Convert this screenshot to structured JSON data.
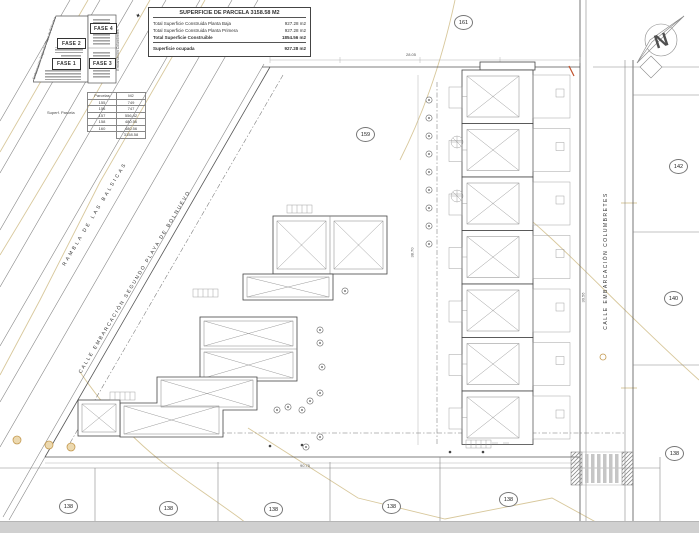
{
  "summary_table": {
    "title": "SUPERFICIE DE PARCELA 3158.58 M2",
    "rows": [
      {
        "label": "Total Superficie Construida Planta Baja",
        "value": "927.28 m2"
      },
      {
        "label": "Total Superficie Construida Planta Primera",
        "value": "927.28 m2"
      },
      {
        "label": "Total Superficie Construible",
        "value": "1854.56 m2"
      },
      {
        "label": "Superficie ocupada",
        "value": "927.28 m2"
      }
    ]
  },
  "phase_key": {
    "fase1": "FASE 1",
    "fase2": "FASE 2",
    "fase3": "FASE 3",
    "fase4": "FASE 4",
    "left_street": "Embarcación Segundo Playa de Bolnuevo",
    "right_street": "Embarcación Columbretes",
    "compass_glyph": "✦"
  },
  "parcel_table": {
    "side_label": "Superf. Parcela",
    "col1": "Parcelas",
    "col2": "M2",
    "rows": [
      [
        "155",
        "749"
      ],
      [
        "156",
        "747"
      ],
      [
        "157",
        "556.42"
      ],
      [
        "158",
        "480.56"
      ],
      [
        "160",
        "480.56"
      ]
    ],
    "total": "3158.58"
  },
  "street_labels": {
    "rambla": "RAMBLA DE LAS BALSICAS",
    "calle_sw": "CALLE EMBARCACIÓN SEGUNDO PLAYA DE BOLNUEVO",
    "calle_e": "CALLE EMBARCACIÓN COLUMBRETES"
  },
  "parcel_numbers": [
    "161",
    "159",
    "142",
    "140",
    "138",
    "138",
    "138",
    "138",
    "138",
    "138"
  ],
  "dimensions": {
    "top": "28.05",
    "bottom": "90.75",
    "right": "30.56",
    "left": "38.70"
  },
  "north_label": "N",
  "colors": {
    "contour": "#d8c89c",
    "line": "#555555",
    "accent_orange": "#c49a50"
  }
}
